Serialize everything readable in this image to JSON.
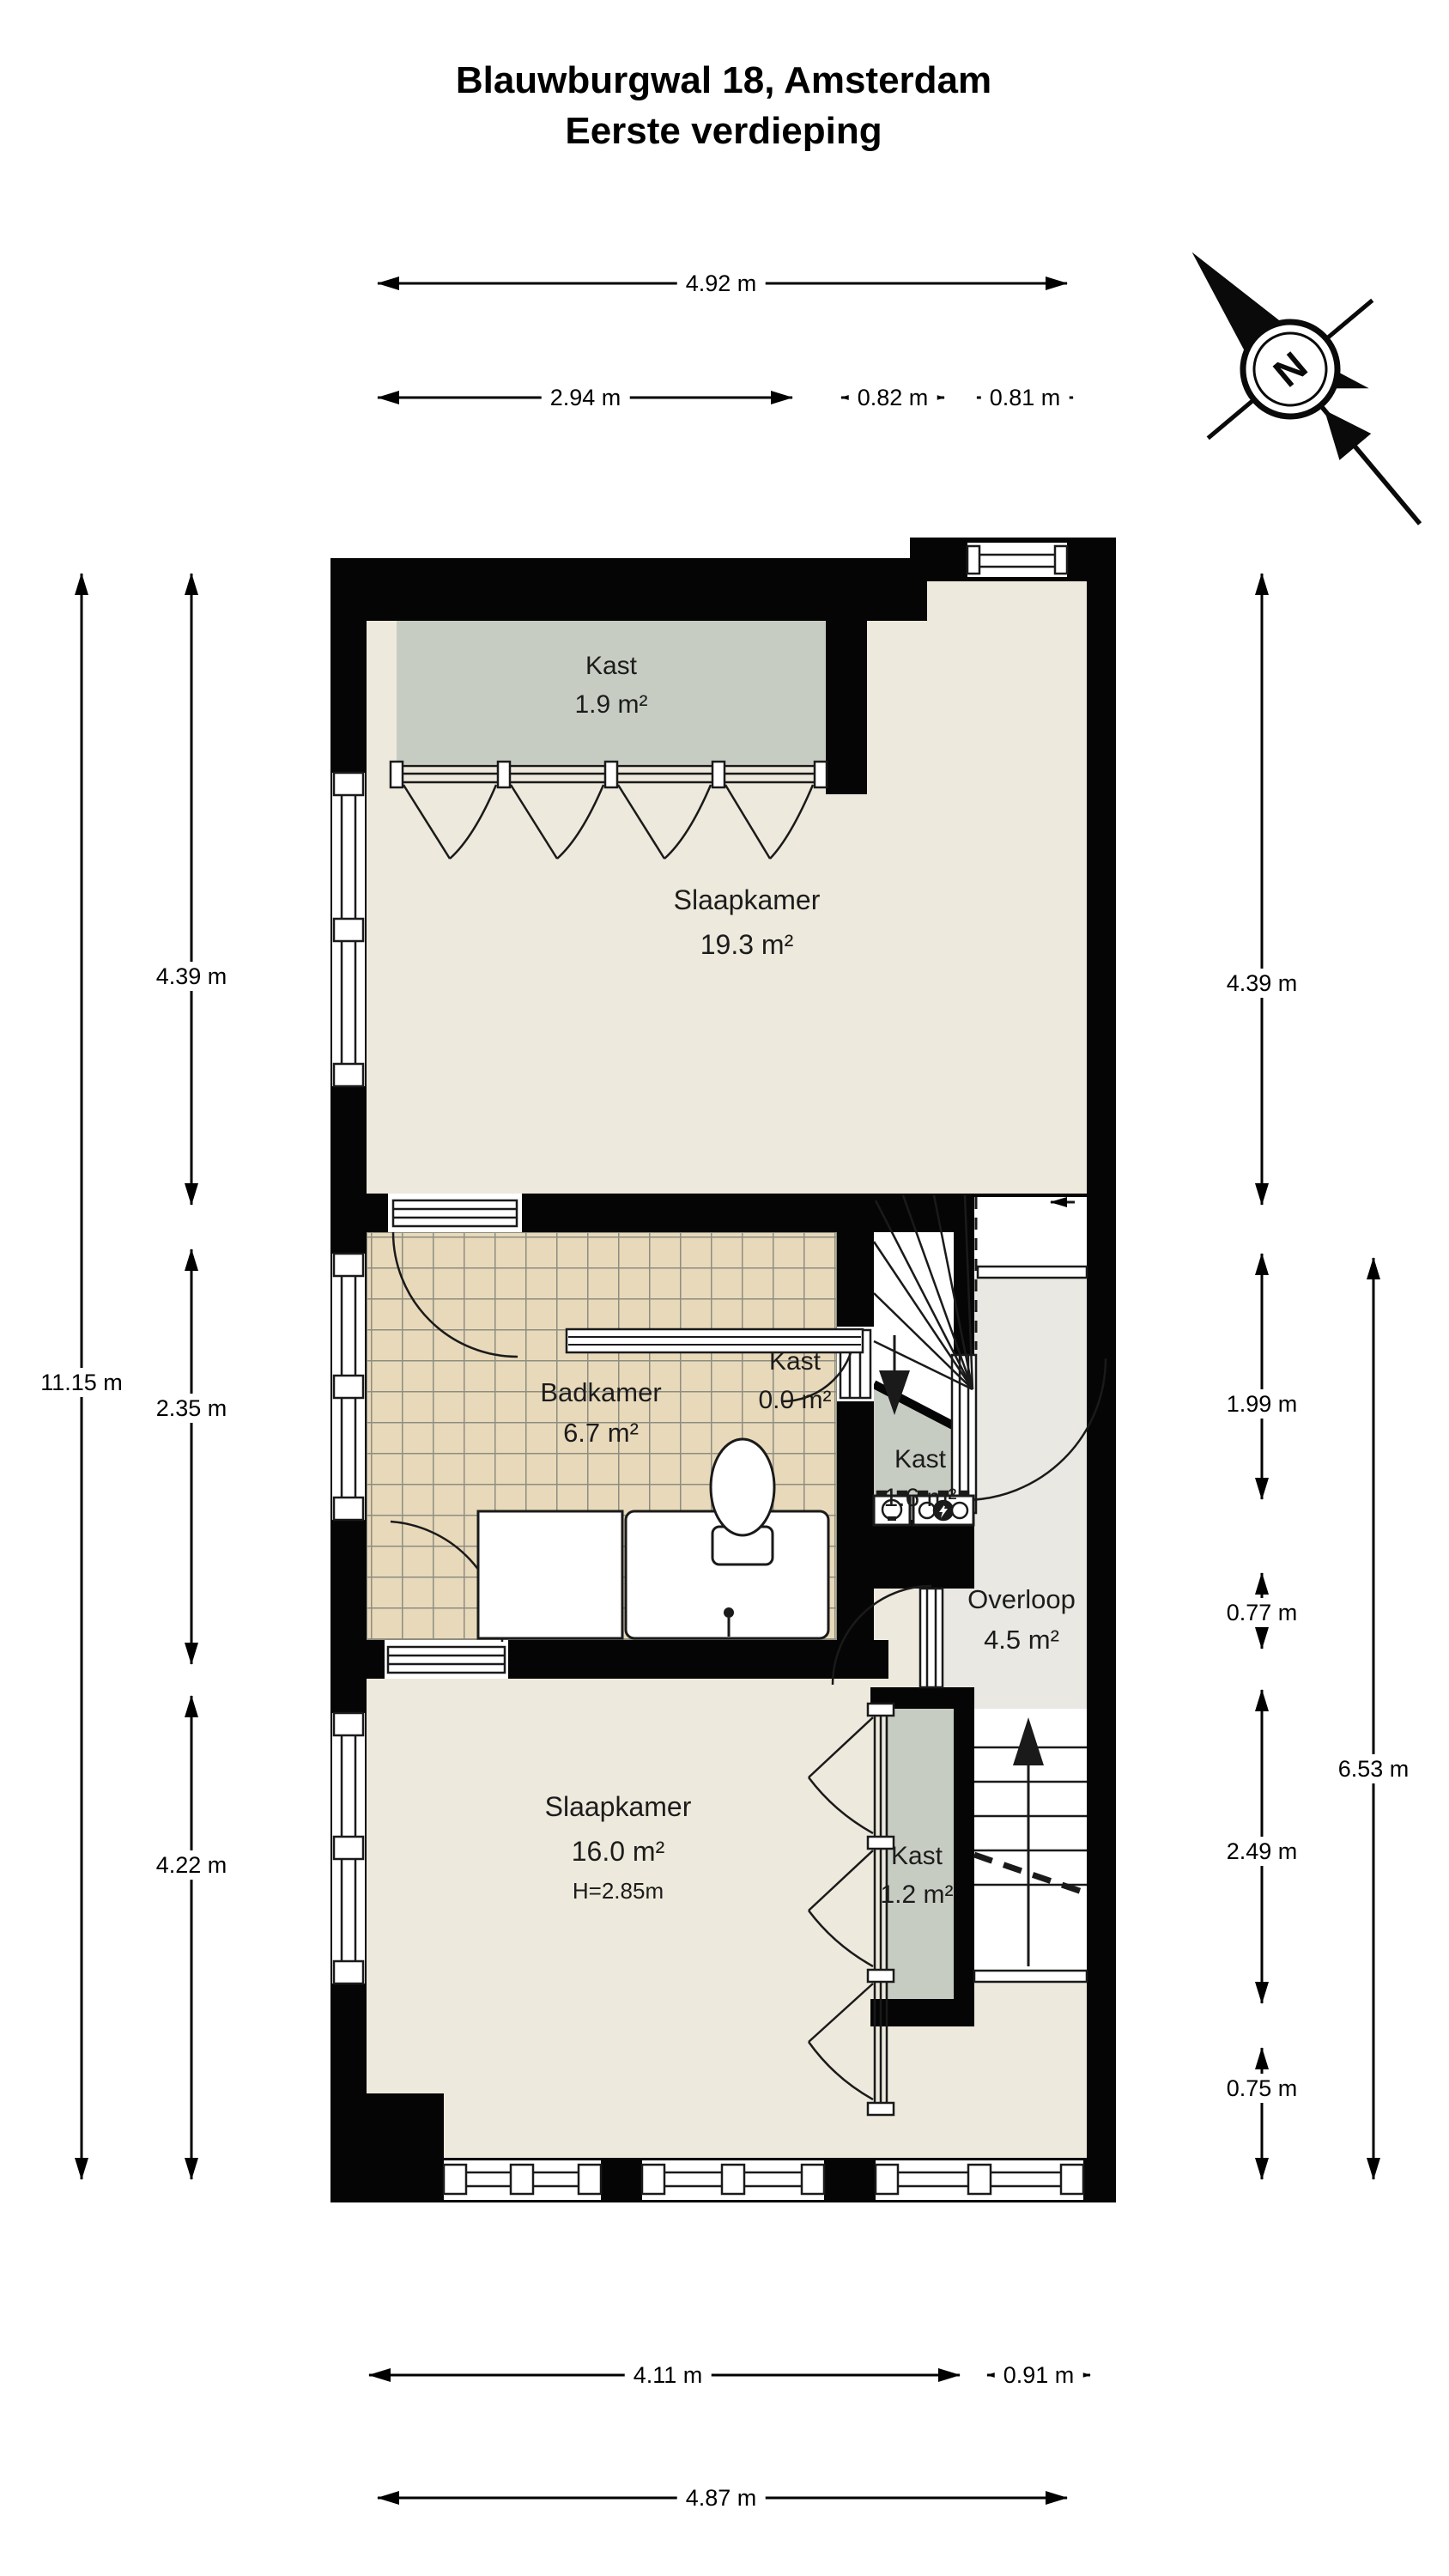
{
  "title": {
    "line1": "Blauwburgwal 18, Amsterdam",
    "line2": "Eerste verdieping"
  },
  "compass": {
    "north_label": "N"
  },
  "rooms": {
    "kast_boven": {
      "name": "Kast",
      "area": "1.9 m²"
    },
    "slaapkamer_1": {
      "name": "Slaapkamer",
      "area": "19.3 m²"
    },
    "badkamer": {
      "name": "Badkamer",
      "area": "6.7 m²"
    },
    "kast_nul": {
      "name": "Kast",
      "area": "0.0 m²"
    },
    "kast_trap": {
      "name": "Kast",
      "area": "1.6 m²"
    },
    "overloop": {
      "name": "Overloop",
      "area": "4.5 m²"
    },
    "slaapkamer_2": {
      "name": "Slaapkamer",
      "area": "16.0 m²",
      "ceiling_height": "H=2.85m"
    },
    "kast_smal": {
      "name": "Kast",
      "area": "1.2 m²"
    }
  },
  "dimensions": {
    "top_total": "4.92 m",
    "top_left": "2.94 m",
    "top_mid": "0.82 m",
    "top_right": "0.81 m",
    "left_total": "11.15 m",
    "left_top": "4.39 m",
    "left_mid": "2.35 m",
    "left_bottom": "4.22 m",
    "right_top": "4.39 m",
    "right_upper": "1.99 m",
    "right_overloop": "0.77 m",
    "right_lower": "2.49 m",
    "right_bottom": "0.75 m",
    "right_total": "6.53 m",
    "bottom_left": "4.11 m",
    "bottom_right": "0.91 m",
    "bottom_total": "4.87 m"
  },
  "colors": {
    "wall": "#050505",
    "floor": "#ede9dc",
    "closet": "#c7ccc3",
    "landing": "#e9e8e3",
    "tile": "#e8d9ba",
    "tile_grid": "#8d8d80"
  }
}
